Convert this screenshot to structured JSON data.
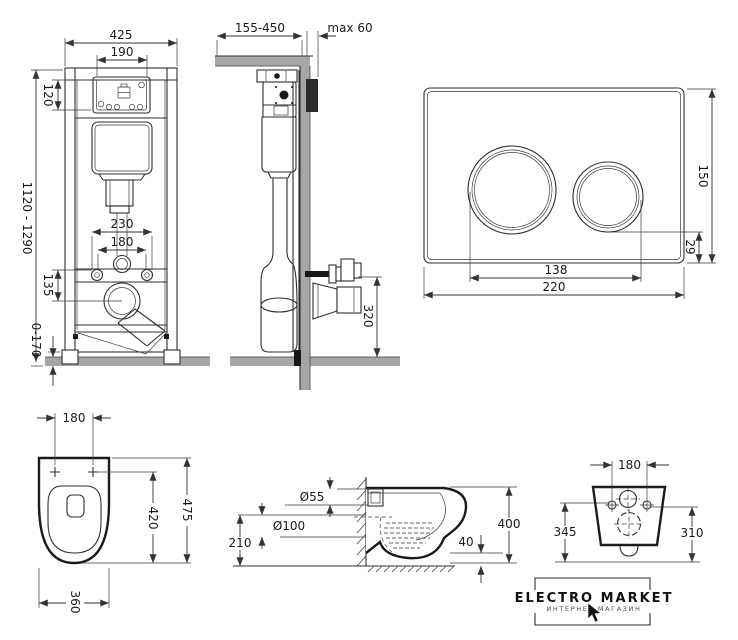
{
  "drawing": {
    "frame_front": {
      "width": "425",
      "service_opening_width": "190",
      "service_opening_height": "120",
      "height_range": "1120 - 1290",
      "fixing_spacing_wide": "230",
      "fixing_spacing": "180",
      "drain_drop": "135",
      "foot_adjust": "0-170"
    },
    "frame_side": {
      "depth_range": "155-450",
      "wall_clearance": "max 60",
      "outlet_height": "320"
    },
    "flush_plate": {
      "width": "220",
      "height": "150",
      "button_spacing": "138",
      "bottom_margin": "29"
    },
    "bowl_top": {
      "fixing_spacing": "180",
      "depth": "475",
      "inner_depth": "420",
      "width": "360"
    },
    "bowl_side": {
      "inlet_diameter": "Ø55",
      "outlet_diameter": "Ø100",
      "outlet_center_height": "210",
      "depth": "400",
      "rim_offset": "40"
    },
    "bowl_back": {
      "fixing_spacing": "180",
      "height_left": "345",
      "height_right": "310"
    },
    "logo": {
      "brand": "ELECTRO MARKET",
      "tagline": "ИНТЕРНЕТ-МАГАЗИН"
    }
  },
  "colors": {
    "line": "#2e2e2e",
    "gray": "#a6a6a6",
    "bracket": "#2b2b2b"
  }
}
